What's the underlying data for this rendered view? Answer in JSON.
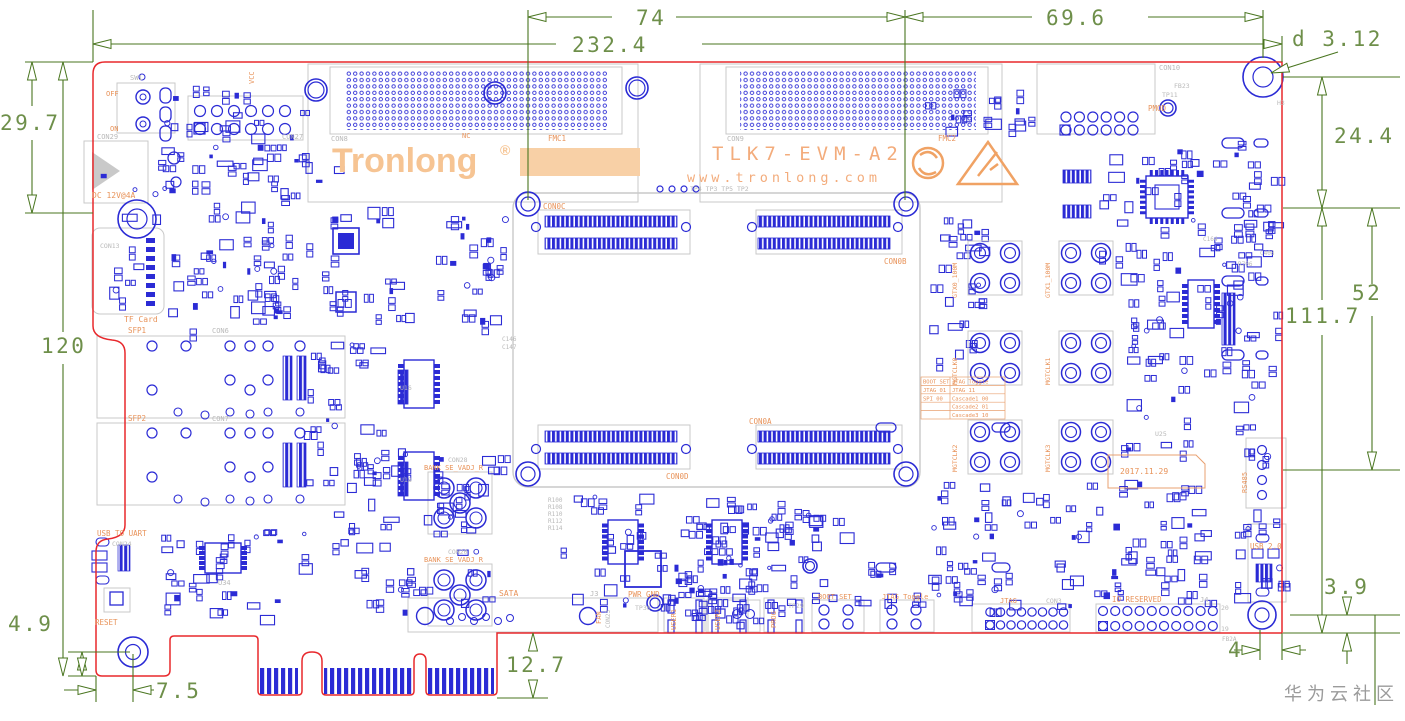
{
  "colors": {
    "board_outline": "#e8282c",
    "component_blue": "#2b2bd5",
    "silkscreen_gray": "#c9c9c9",
    "gray_text": "#b9b9b9",
    "dimension_green": "#49751f",
    "dimension_text_green": "#6e8f4a",
    "label_orange": "#e8935a",
    "logo_orange": "#f6c493",
    "block_orange": "#f8d0a6"
  },
  "dimensions": {
    "top_span_mid": "74",
    "top_span_full": "232.4",
    "top_span_right": "69.6",
    "hole_diameter": "d 3.12",
    "left_upper": "29.7",
    "left_full": "120",
    "right_upper": "24.4",
    "right_mid": "52",
    "right_full": "111.7",
    "bottom_left_offset": "4.9",
    "bottom_left_inset": "7.5",
    "edge_tab_depth": "12.7",
    "bottom_right_offset": "3.9",
    "bottom_right_inset": "4"
  },
  "branding": {
    "logo": "Tronlong",
    "registered": "®",
    "model": "TLK7-EVM-A2",
    "website": "www.tronlong.com",
    "date": "2017.11.29"
  },
  "watermark": "华为云社区",
  "boot_table": {
    "rows": [
      [
        "BOOT SET",
        "JTAG Toggle"
      ],
      [
        "JTAG 01",
        "JTAG    11"
      ],
      [
        "SPI  00",
        "Cascade1 00"
      ],
      [
        "",
        "Cascade2 01"
      ],
      [
        "",
        "Cascade3 10"
      ]
    ]
  },
  "labels": [
    {
      "t": "OFF",
      "x": 106,
      "y": 96,
      "c": "o",
      "s": 7
    },
    {
      "t": "ON",
      "x": 110,
      "y": 131,
      "c": "o",
      "s": 7
    },
    {
      "t": "SW1",
      "x": 130,
      "y": 80,
      "c": "g",
      "s": 7
    },
    {
      "t": "VCC",
      "x": 254,
      "y": 84,
      "c": "o",
      "s": 7,
      "r": -90
    },
    {
      "t": "CON29",
      "x": 97,
      "y": 139,
      "c": "g",
      "s": 7
    },
    {
      "t": "CON27",
      "x": 282,
      "y": 139,
      "c": "g",
      "s": 7
    },
    {
      "t": "DC 12V@4A",
      "x": 92,
      "y": 198,
      "c": "o",
      "s": 8
    },
    {
      "t": "TF Card",
      "x": 124,
      "y": 322,
      "c": "o",
      "s": 8
    },
    {
      "t": "CON13",
      "x": 100,
      "y": 248,
      "c": "g",
      "s": 6.5
    },
    {
      "t": "SFP1",
      "x": 128,
      "y": 333,
      "c": "o",
      "s": 7.5
    },
    {
      "t": "CON6",
      "x": 212,
      "y": 333,
      "c": "g",
      "s": 7
    },
    {
      "t": "SFP2",
      "x": 128,
      "y": 421,
      "c": "o",
      "s": 7.5
    },
    {
      "t": "CON7",
      "x": 212,
      "y": 421,
      "c": "g",
      "s": 7
    },
    {
      "t": "CON8",
      "x": 331,
      "y": 141,
      "c": "g",
      "s": 7
    },
    {
      "t": "FMC1",
      "x": 548,
      "y": 141,
      "c": "o",
      "s": 7.5
    },
    {
      "t": "CON9",
      "x": 727,
      "y": 141,
      "c": "g",
      "s": 7
    },
    {
      "t": "FMC2",
      "x": 938,
      "y": 141,
      "c": "o",
      "s": 7.5
    },
    {
      "t": "NC",
      "x": 462,
      "y": 138,
      "c": "o",
      "s": 7
    },
    {
      "t": "CON10",
      "x": 1159,
      "y": 70,
      "c": "g",
      "s": 7
    },
    {
      "t": "PMOD",
      "x": 1148,
      "y": 111,
      "c": "o",
      "s": 7.5
    },
    {
      "t": "TP11",
      "x": 1162,
      "y": 97,
      "c": "g",
      "s": 6.5
    },
    {
      "t": "FB23",
      "x": 1174,
      "y": 88,
      "c": "g",
      "s": 6.5
    },
    {
      "t": "H3",
      "x": 1277,
      "y": 105,
      "c": "g",
      "s": 6.5
    },
    {
      "t": "TP4 TP3 TP5 TP2",
      "x": 690,
      "y": 191,
      "c": "g",
      "s": 6.5
    },
    {
      "t": "CON0C",
      "x": 543,
      "y": 209,
      "c": "o",
      "s": 7.5
    },
    {
      "t": "CON0B",
      "x": 884,
      "y": 264,
      "c": "o",
      "s": 7.5
    },
    {
      "t": "CON0D",
      "x": 666,
      "y": 479,
      "c": "o",
      "s": 7.5
    },
    {
      "t": "CON0A",
      "x": 749,
      "y": 424,
      "c": "o",
      "s": 7.5
    },
    {
      "t": "USB TO UART",
      "x": 97,
      "y": 536,
      "c": "o",
      "s": 7.5
    },
    {
      "t": "CON24",
      "x": 112,
      "y": 546,
      "c": "g",
      "s": 6.5
    },
    {
      "t": "RESET",
      "x": 95,
      "y": 625,
      "c": "o",
      "s": 7.5
    },
    {
      "t": "SATA",
      "x": 499,
      "y": 596,
      "c": "o",
      "s": 8
    },
    {
      "t": "J3",
      "x": 590,
      "y": 596,
      "c": "g",
      "s": 7
    },
    {
      "t": "PWR GND",
      "x": 628,
      "y": 597,
      "c": "o",
      "s": 7.5
    },
    {
      "t": "FAN",
      "x": 601,
      "y": 624,
      "c": "o",
      "s": 7,
      "r": -90
    },
    {
      "t": "CON23",
      "x": 610,
      "y": 628,
      "c": "g",
      "s": 6,
      "r": -90
    },
    {
      "t": "USER1",
      "x": 676,
      "y": 630,
      "c": "o",
      "s": 7,
      "r": -90
    },
    {
      "t": "USER2",
      "x": 720,
      "y": 630,
      "c": "o",
      "s": 7,
      "r": -90
    },
    {
      "t": "PROG",
      "x": 776,
      "y": 628,
      "c": "o",
      "s": 7,
      "r": -90
    },
    {
      "t": "BOOT SET",
      "x": 818,
      "y": 599,
      "c": "o",
      "s": 7
    },
    {
      "t": "JTAG Toggle",
      "x": 882,
      "y": 599,
      "c": "o",
      "s": 7
    },
    {
      "t": "JTAG",
      "x": 1000,
      "y": 603,
      "c": "o",
      "s": 7
    },
    {
      "t": "CON3",
      "x": 1046,
      "y": 603,
      "c": "g",
      "s": 6.5
    },
    {
      "t": "IO RESERVED",
      "x": 1112,
      "y": 602,
      "c": "o",
      "s": 7.5
    },
    {
      "t": "J4",
      "x": 1200,
      "y": 602,
      "c": "g",
      "s": 7
    },
    {
      "t": "20",
      "x": 1221,
      "y": 610,
      "c": "g",
      "s": 6.5
    },
    {
      "t": "19",
      "x": 1221,
      "y": 631,
      "c": "g",
      "s": 6.5
    },
    {
      "t": "USB 2.0",
      "x": 1250,
      "y": 549,
      "c": "o",
      "s": 7.5
    },
    {
      "t": "RS485",
      "x": 1247,
      "y": 493,
      "c": "o",
      "s": 7,
      "r": -90
    },
    {
      "t": "BANK SE_VADJ_R",
      "x": 424,
      "y": 470,
      "c": "o",
      "s": 7
    },
    {
      "t": "CON28",
      "x": 448,
      "y": 462,
      "c": "g",
      "s": 6.5
    },
    {
      "t": "BANK SE_VADJ_R",
      "x": 424,
      "y": 562,
      "c": "o",
      "s": 7
    },
    {
      "t": "CON20",
      "x": 448,
      "y": 554,
      "c": "g",
      "s": 6.5
    },
    {
      "t": "GTX0_100M",
      "x": 957,
      "y": 298,
      "c": "o",
      "s": 6.5,
      "r": -90
    },
    {
      "t": "GTX1_100M",
      "x": 1050,
      "y": 298,
      "c": "o",
      "s": 6.5,
      "r": -90
    },
    {
      "t": "MGTCLK0",
      "x": 957,
      "y": 385,
      "c": "o",
      "s": 6.5,
      "r": -90
    },
    {
      "t": "MGTCLK1",
      "x": 1050,
      "y": 385,
      "c": "o",
      "s": 6.5,
      "r": -90
    },
    {
      "t": "MGTCLK2",
      "x": 957,
      "y": 472,
      "c": "o",
      "s": 6.5,
      "r": -90
    },
    {
      "t": "MGTCLK3",
      "x": 1050,
      "y": 472,
      "c": "o",
      "s": 6.5,
      "r": -90
    },
    {
      "t": "U34",
      "x": 218,
      "y": 585,
      "c": "g",
      "s": 7
    },
    {
      "t": "U25",
      "x": 1155,
      "y": 436,
      "c": "g",
      "s": 6.5
    },
    {
      "t": "U16",
      "x": 400,
      "y": 390,
      "c": "g",
      "s": 6.5
    },
    {
      "t": "U18",
      "x": 400,
      "y": 482,
      "c": "g",
      "s": 6.5
    },
    {
      "t": "C146",
      "x": 502,
      "y": 341,
      "c": "g",
      "s": 6
    },
    {
      "t": "C147",
      "x": 502,
      "y": 349,
      "c": "g",
      "s": 6
    },
    {
      "t": "R100",
      "x": 548,
      "y": 502,
      "c": "g",
      "s": 6
    },
    {
      "t": "R108",
      "x": 548,
      "y": 509,
      "c": "g",
      "s": 6
    },
    {
      "t": "R110",
      "x": 548,
      "y": 516,
      "c": "g",
      "s": 6
    },
    {
      "t": "R112",
      "x": 548,
      "y": 523,
      "c": "g",
      "s": 6
    },
    {
      "t": "R114",
      "x": 548,
      "y": 530,
      "c": "g",
      "s": 6
    },
    {
      "t": "C164",
      "x": 1203,
      "y": 241,
      "c": "g",
      "s": 6
    },
    {
      "t": "C408",
      "x": 1260,
      "y": 255,
      "c": "g",
      "s": 6
    },
    {
      "t": "R706",
      "x": 1238,
      "y": 266,
      "c": "g",
      "s": 6
    },
    {
      "t": "TP30",
      "x": 635,
      "y": 610,
      "c": "g",
      "s": 6.5
    },
    {
      "t": "TP29",
      "x": 788,
      "y": 608,
      "c": "g",
      "s": 6.5
    },
    {
      "t": "FB2A",
      "x": 1222,
      "y": 641,
      "c": "g",
      "s": 6
    }
  ]
}
